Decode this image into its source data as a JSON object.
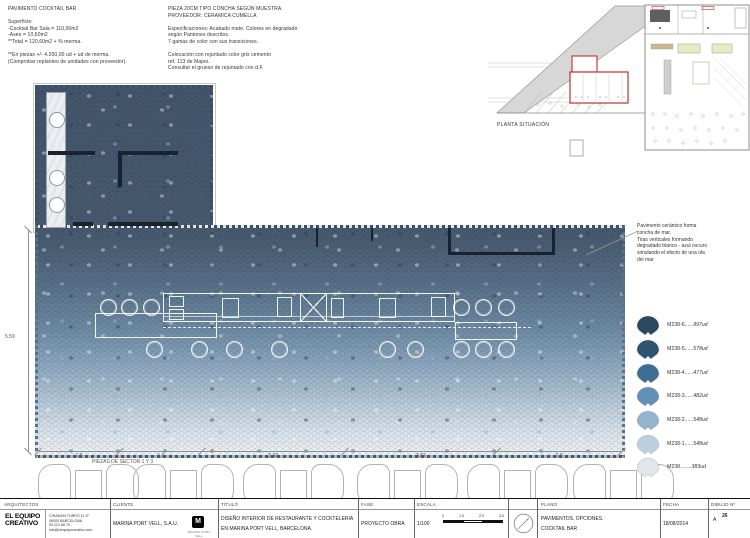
{
  "notes_left": {
    "text": "PAVIMENTO COCKTAIL BAR\n\nSuperficie:\n-Cocktail Bar Sala = 110,00m2\n-Aseo = 10,60m2\n**Total = 120,60m2 + % merma.\n\n**En piezas +/-  4.200,00 ud + ud de merma.\n(Comprobar replanteo de unidades con proveedor)."
  },
  "notes_center": {
    "text": "PIEZA 20CM TIPO CONCHA SEGÚN MUESTRA.\nPROVEEDOR: CERAMICA CUMELLA\n\nEspecificaciones: Acabado mate. Colores en degradado\nsegún Pantones descritos.\n7 gamas de color con sus transiciones.\n\nColocación con rejuntado color gris cemento\nref. 113 de Mapei.\nConsultar el grueso de rejuntado con d.F."
  },
  "site_plan": {
    "label": "PLANTA SITUACIÓN"
  },
  "plan": {
    "dim_left": "5.59",
    "dims_bottom": [
      "1.9",
      "1.9",
      "3.32",
      "3.52",
      "2.9"
    ],
    "sector_label": "PIEZAS DE SECTOR 1 Y 3"
  },
  "legend": {
    "note": "Pavimento cerámico forma\nconcha de mar.\nTiras verticales formando\ndegradado blanco - azul oscuro\nsimulando el efecto de una ola\ndel mar",
    "items": [
      {
        "name": "M238-6",
        "dots": "......",
        "units": "997ud",
        "color": "#2c4960"
      },
      {
        "name": "M238-5",
        "dots": "......",
        "units": "578ud",
        "color": "#2f5472"
      },
      {
        "name": "M238-4",
        "dots": "......",
        "units": "477ud",
        "color": "#3f6e95"
      },
      {
        "name": "M238-3",
        "dots": "......",
        "units": "482ud",
        "color": "#6191b8"
      },
      {
        "name": "M238-2",
        "dots": "......",
        "units": "548ud",
        "color": "#93b4cf"
      },
      {
        "name": "M238-1",
        "dots": "......",
        "units": "548ud",
        "color": "#bdd0e0"
      },
      {
        "name": "M238",
        "dots": "........",
        "units": "383ud",
        "color": "#e0e6ea"
      }
    ]
  },
  "title_block": {
    "col_architects_label": "ARQUITECTOS",
    "architects_name_line1": "EL EQUIPO",
    "architects_name_line2": "CREATIVO",
    "architects_address": "C/RAMON TURRÓ 11 3º\n08005 BARCELONA\n93 221 68 70 - info@elequipocreativo.com",
    "col_client_label": "CLIENTE",
    "client_name": "MARINA PORT VELL, S.A.U.",
    "client_logo_letter": "M",
    "client_logo_caption": "MARINA PORT VELL",
    "col_title_label": "TÍTULO",
    "title_line1": "DISEÑO INTERIOR DE RESTAURANTE Y COCKTELERIA",
    "title_line2": "EN MARINA PORT VELL, BARCELONA.",
    "col_fase_label": "FASE",
    "fase": "PROYECTO OBRA",
    "col_escala_label": "ESCALA",
    "escala": "1/100",
    "scale_ticks": [
      "0",
      "1,0",
      "2,0",
      "3,0"
    ],
    "col_plano_label": "PLANO",
    "plano_line1": "PAVIMENTOS. OPCIONES.",
    "plano_line2": "COCKTAIL BAR",
    "col_fecha_label": "FECHA",
    "fecha": "18/08/2014",
    "col_dibujo_label": "DIBUJO Nº",
    "dibujo_prefix": "A",
    "dibujo_num": "26"
  }
}
